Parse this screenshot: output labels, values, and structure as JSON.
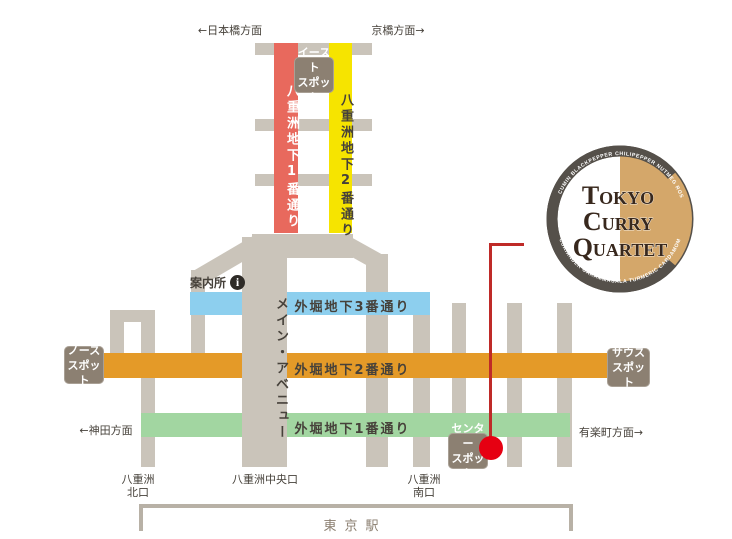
{
  "directions": {
    "nihonbashi": "←日本橋方面",
    "kyobashi": "京橋方面→",
    "kanda": "←神田方面",
    "yurakucho": "有楽町方面→"
  },
  "streets": {
    "yaesu1": "八重洲地下1番通り",
    "yaesu2": "八重洲地下2番通り",
    "sotobori3": "外堀地下3番通り",
    "sotobori2": "外堀地下2番通り",
    "sotobori1": "外堀地下1番通り",
    "main_avenue": "メイン・アベニュー"
  },
  "spots": {
    "east": "イースト\nスポット",
    "north": "ノース\nスポット",
    "south": "サウス\nスポット",
    "center": "センター\nスポット"
  },
  "info": {
    "label": "案内所",
    "icon_glyph": "i"
  },
  "station": {
    "name": "東京駅",
    "exit_north": "八重洲\n北口",
    "exit_central": "八重洲中央口",
    "exit_south": "八重洲\n南口"
  },
  "logo": {
    "line1": "Tokyo",
    "line2": "Curry",
    "line3": "Quartet",
    "ring_text_top": "GINGER CUMIN BLACKPEPPER CHILIPEPPER NUTMEG ROSEMARY",
    "ring_text_bottom": "CORIANDER GARAMMASALA TURMERIC CARDAMOM"
  },
  "colors": {
    "street_red": "#e8695d",
    "street_yellow": "#f6e400",
    "street_blue": "#8dcfee",
    "street_orange": "#e49a28",
    "street_green": "#a2d6a1",
    "corridor_gray": "#cac4ba",
    "spot_brown": "#8c8072",
    "route_red": "#e60012",
    "logo_ring": "#55504a",
    "logo_tan": "#d4a76a"
  }
}
